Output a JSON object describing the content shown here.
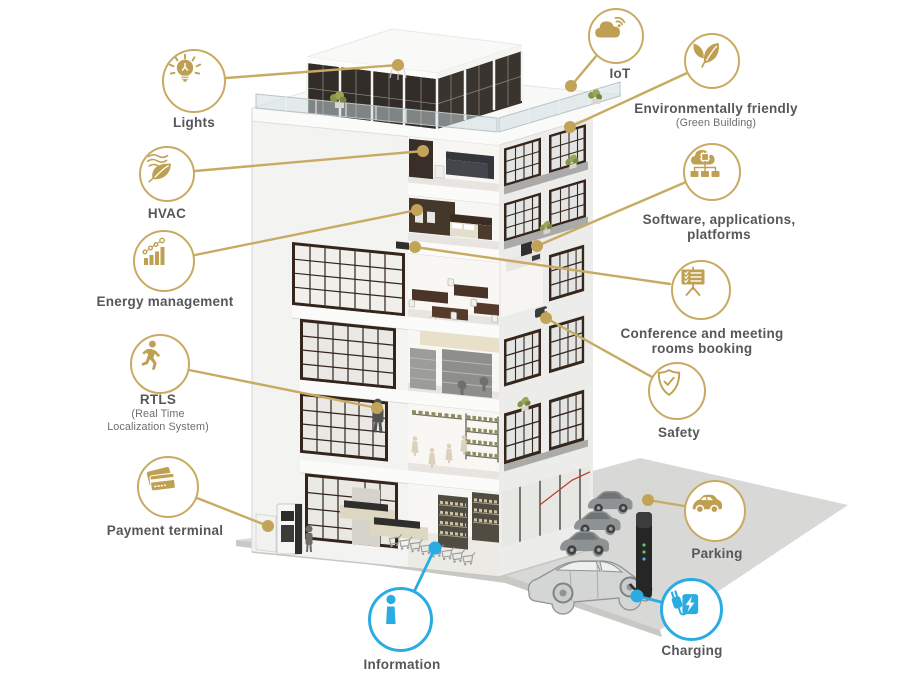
{
  "palette": {
    "gold_line": "#C8AA62",
    "gold_icon": "#BFA052",
    "blue": "#2AACE3",
    "label_text": "#56575A",
    "sublabel_text": "#6D6E71",
    "wall_white": "#F3F3F1",
    "window_frame": "#36261C",
    "ground_gray": "#D8D8D6"
  },
  "callouts": {
    "lights": {
      "label": "Lights"
    },
    "hvac": {
      "label": "HVAC"
    },
    "energy": {
      "label": "Energy management"
    },
    "rtls": {
      "label": "RTLS",
      "sublabel": "(Real Time\nLocalization System)"
    },
    "payment": {
      "label": "Payment terminal"
    },
    "iot": {
      "label": "IoT"
    },
    "env": {
      "label": "Environmentally friendly",
      "sublabel": "(Green Building)"
    },
    "software": {
      "label": "Software, applications,\nplatforms"
    },
    "conference": {
      "label": "Conference and meeting\nrooms booking"
    },
    "safety": {
      "label": "Safety"
    },
    "parking": {
      "label": "Parking"
    },
    "charging": {
      "label": "Charging"
    },
    "information": {
      "label": "Information"
    }
  }
}
